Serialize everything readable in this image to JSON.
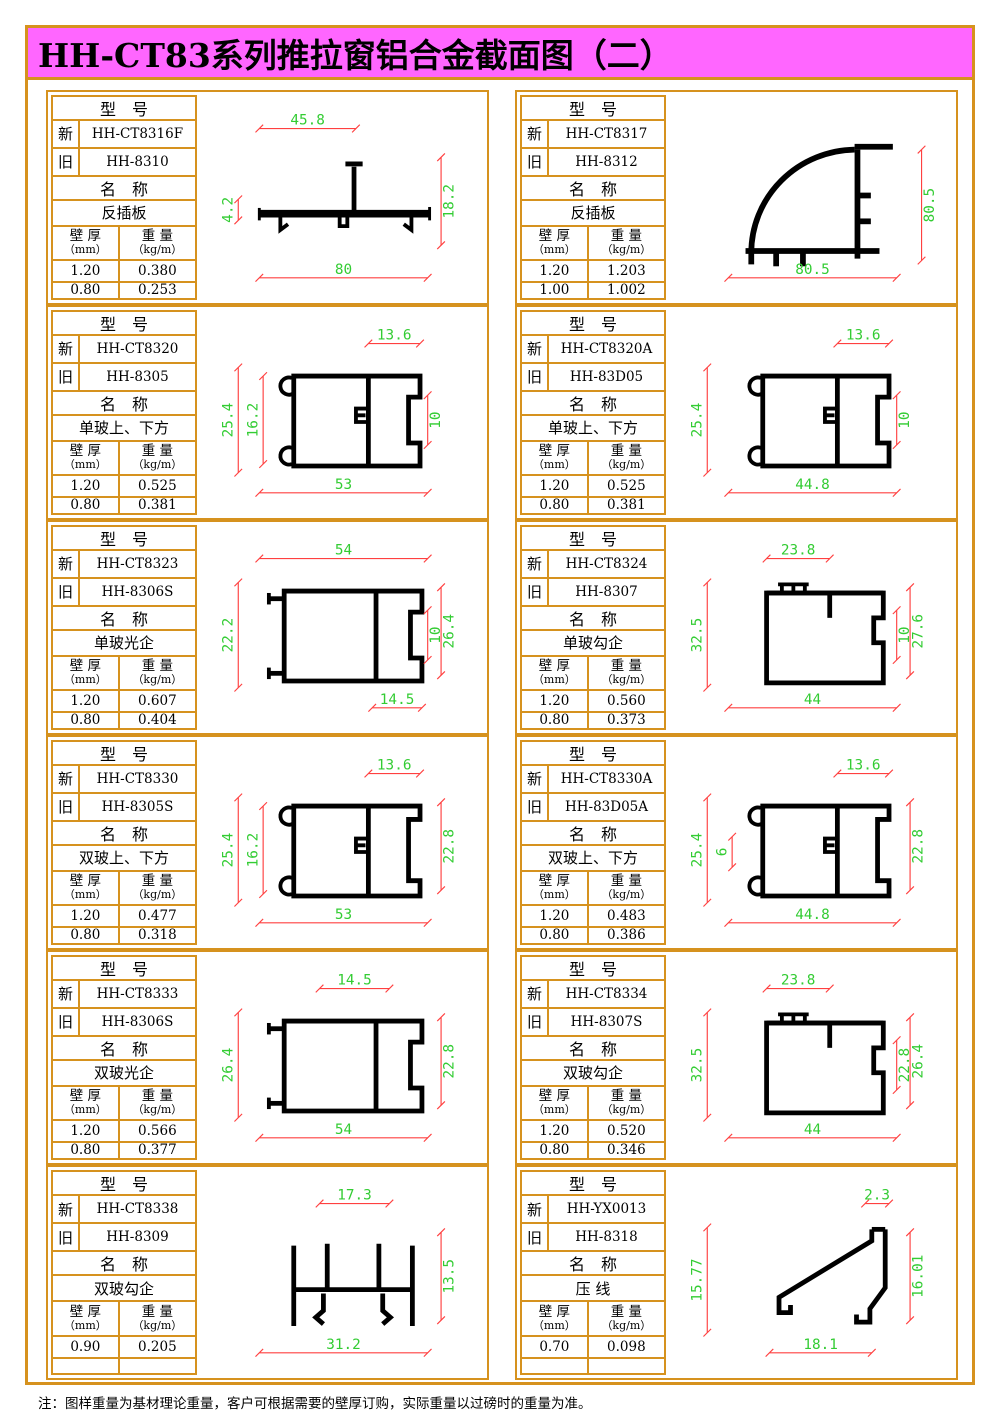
{
  "header": {
    "title": "HH-CT83系列推拉窗铝合金截面图（二）"
  },
  "labels": {
    "model_header": "型　号",
    "new_label": "新",
    "old_label": "旧",
    "name_header": "名　称",
    "thickness_label": "壁 厚",
    "thickness_unit": "（mm）",
    "weight_label": "重 量",
    "weight_unit": "（kg/m）"
  },
  "colors": {
    "border": "#d6921e",
    "header_bg": "#ff66ff",
    "dim_line": "#ff4040",
    "dim_text": "#33cc33",
    "profile": "#000000"
  },
  "footer": {
    "note": "注：图样重量为基材理论重量，客户可根据需要的壁厚订购，实际重量以过磅时的重量为准。"
  },
  "cells": [
    {
      "model_new": "HH-CT8316F",
      "model_old": "HH-8310",
      "name": "反插板",
      "values": [
        [
          "1.20",
          "0.380"
        ],
        [
          "0.80",
          "0.253"
        ]
      ],
      "drawing": {
        "shape": "flat-bar",
        "dims": [
          {
            "label": "45.8",
            "side": "top",
            "pos": "left"
          },
          {
            "label": "4.2",
            "side": "left",
            "pos": "short"
          },
          {
            "label": "18.2",
            "side": "right",
            "pos": "mid"
          },
          {
            "label": "80",
            "side": "bottom",
            "pos": "full"
          }
        ]
      }
    },
    {
      "model_new": "HH-CT8317",
      "model_old": "HH-8312",
      "name": "反插板",
      "values": [
        [
          "1.20",
          "1.203"
        ],
        [
          "1.00",
          "1.002"
        ]
      ],
      "drawing": {
        "shape": "quarter-arc",
        "dims": [
          {
            "label": "80.5",
            "side": "right",
            "pos": "outer"
          },
          {
            "label": "80.5",
            "side": "bottom",
            "pos": "full"
          }
        ]
      }
    },
    {
      "model_new": "HH-CT8320",
      "model_old": "HH-8305",
      "name": "单玻上、下方",
      "values": [
        [
          "1.20",
          "0.525"
        ],
        [
          "0.80",
          "0.381"
        ]
      ],
      "drawing": {
        "shape": "box-c-left",
        "dims": [
          {
            "label": "13.6",
            "side": "top",
            "pos": "right"
          },
          {
            "label": "25.4",
            "side": "left",
            "pos": "outer"
          },
          {
            "label": "16.2",
            "side": "left",
            "pos": "inner"
          },
          {
            "label": "10",
            "side": "right",
            "pos": "inner"
          },
          {
            "label": "53",
            "side": "bottom",
            "pos": "full"
          }
        ]
      }
    },
    {
      "model_new": "HH-CT8320A",
      "model_old": "HH-83D05",
      "name": "单玻上、下方",
      "values": [
        [
          "1.20",
          "0.525"
        ],
        [
          "0.80",
          "0.381"
        ]
      ],
      "drawing": {
        "shape": "box-c-left",
        "dims": [
          {
            "label": "13.6",
            "side": "top",
            "pos": "right"
          },
          {
            "label": "25.4",
            "side": "left",
            "pos": "outer"
          },
          {
            "label": "10",
            "side": "right",
            "pos": "inner"
          },
          {
            "label": "44.8",
            "side": "bottom",
            "pos": "full"
          }
        ]
      }
    },
    {
      "model_new": "HH-CT8323",
      "model_old": "HH-8306S",
      "name": "单玻光企",
      "values": [
        [
          "1.20",
          "0.607"
        ],
        [
          "0.80",
          "0.404"
        ]
      ],
      "drawing": {
        "shape": "wide-box",
        "dims": [
          {
            "label": "54",
            "side": "top",
            "pos": "full"
          },
          {
            "label": "22.2",
            "side": "left",
            "pos": "outer"
          },
          {
            "label": "10",
            "side": "right",
            "pos": "inner"
          },
          {
            "label": "26.4",
            "side": "right",
            "pos": "mid"
          },
          {
            "label": "14.5",
            "side": "bottom",
            "pos": "right"
          }
        ]
      }
    },
    {
      "model_new": "HH-CT8324",
      "model_old": "HH-8307",
      "name": "单玻勾企",
      "values": [
        [
          "1.20",
          "0.560"
        ],
        [
          "0.80",
          "0.373"
        ]
      ],
      "drawing": {
        "shape": "hook-box",
        "dims": [
          {
            "label": "23.8",
            "side": "top",
            "pos": "boxleft"
          },
          {
            "label": "32.5",
            "side": "left",
            "pos": "outer"
          },
          {
            "label": "10",
            "side": "right",
            "pos": "inner"
          },
          {
            "label": "27.6",
            "side": "right",
            "pos": "mid"
          },
          {
            "label": "44",
            "side": "bottom",
            "pos": "full"
          }
        ]
      }
    },
    {
      "model_new": "HH-CT8330",
      "model_old": "HH-8305S",
      "name": "双玻上、下方",
      "values": [
        [
          "1.20",
          "0.477"
        ],
        [
          "0.80",
          "0.318"
        ]
      ],
      "drawing": {
        "shape": "box-c-left-tall",
        "dims": [
          {
            "label": "13.6",
            "side": "top",
            "pos": "right"
          },
          {
            "label": "25.4",
            "side": "left",
            "pos": "outer"
          },
          {
            "label": "16.2",
            "side": "left",
            "pos": "inner"
          },
          {
            "label": "22.8",
            "side": "right",
            "pos": "mid"
          },
          {
            "label": "53",
            "side": "bottom",
            "pos": "full"
          }
        ]
      }
    },
    {
      "model_new": "HH-CT8330A",
      "model_old": "HH-83D05A",
      "name": "双玻上、下方",
      "values": [
        [
          "1.20",
          "0.483"
        ],
        [
          "0.80",
          "0.386"
        ]
      ],
      "drawing": {
        "shape": "box-c-left-tall",
        "dims": [
          {
            "label": "13.6",
            "side": "top",
            "pos": "right"
          },
          {
            "label": "25.4",
            "side": "left",
            "pos": "outer"
          },
          {
            "label": "6",
            "side": "left",
            "pos": "innershort"
          },
          {
            "label": "22.8",
            "side": "right",
            "pos": "mid"
          },
          {
            "label": "44.8",
            "side": "bottom",
            "pos": "full"
          }
        ]
      }
    },
    {
      "model_new": "HH-CT8333",
      "model_old": "HH-8306S",
      "name": "双玻光企",
      "values": [
        [
          "1.20",
          "0.566"
        ],
        [
          "0.80",
          "0.377"
        ]
      ],
      "drawing": {
        "shape": "wide-box",
        "dims": [
          {
            "label": "14.5",
            "side": "top",
            "pos": "center"
          },
          {
            "label": "26.4",
            "side": "left",
            "pos": "outer"
          },
          {
            "label": "22.8",
            "side": "right",
            "pos": "mid"
          },
          {
            "label": "54",
            "side": "bottom",
            "pos": "full"
          }
        ]
      }
    },
    {
      "model_new": "HH-CT8334",
      "model_old": "HH-8307S",
      "name": "双玻勾企",
      "values": [
        [
          "1.20",
          "0.520"
        ],
        [
          "0.80",
          "0.346"
        ]
      ],
      "drawing": {
        "shape": "hook-box",
        "dims": [
          {
            "label": "23.8",
            "side": "top",
            "pos": "boxleft"
          },
          {
            "label": "32.5",
            "side": "left",
            "pos": "outer"
          },
          {
            "label": "22.8",
            "side": "right",
            "pos": "inner"
          },
          {
            "label": "26.4",
            "side": "right",
            "pos": "mid"
          },
          {
            "label": "44",
            "side": "bottom",
            "pos": "full"
          }
        ]
      }
    },
    {
      "model_new": "HH-CT8338",
      "model_old": "HH-8309",
      "name": "双玻勾企",
      "values": [
        [
          "0.90",
          "0.205"
        ],
        [
          "",
          ""
        ]
      ],
      "drawing": {
        "shape": "h-profile",
        "dims": [
          {
            "label": "17.3",
            "side": "top",
            "pos": "center"
          },
          {
            "label": "13.5",
            "side": "right",
            "pos": "mid"
          },
          {
            "label": "31.2",
            "side": "bottom",
            "pos": "full"
          }
        ]
      }
    },
    {
      "model_new": "HH-YX0013",
      "model_old": "HH-8318",
      "name": "压 线",
      "values": [
        [
          "0.70",
          "0.098"
        ],
        [
          "",
          ""
        ]
      ],
      "drawing": {
        "shape": "wedge",
        "dims": [
          {
            "label": "2.3",
            "side": "top",
            "pos": "small"
          },
          {
            "label": "15.77",
            "side": "left",
            "pos": "outer"
          },
          {
            "label": "16.01",
            "side": "right",
            "pos": "mid"
          },
          {
            "label": "18.1",
            "side": "bottom",
            "pos": "center"
          }
        ]
      }
    }
  ]
}
